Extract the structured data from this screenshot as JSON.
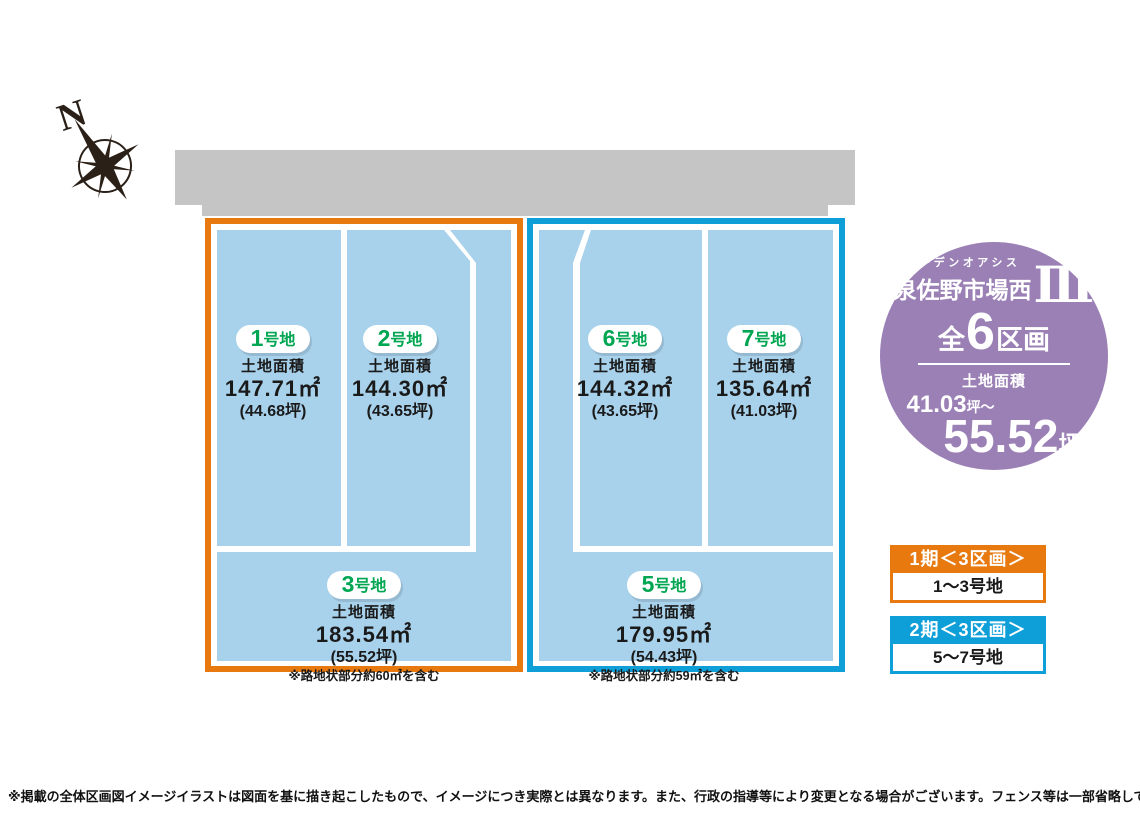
{
  "compass": {
    "label": "N"
  },
  "labels": {
    "area_label": "土地面積"
  },
  "plots": [
    {
      "num": "1",
      "suffix": "号地",
      "area": "147.71㎡",
      "tsubo": "(44.68坪)"
    },
    {
      "num": "2",
      "suffix": "号地",
      "area": "144.30㎡",
      "tsubo": "(43.65坪)"
    },
    {
      "num": "3",
      "suffix": "号地",
      "area": "183.54㎡",
      "tsubo": "(55.52坪)",
      "note": "※路地状部分約60㎡を含む"
    },
    {
      "num": "5",
      "suffix": "号地",
      "area": "179.95㎡",
      "tsubo": "(54.43坪)",
      "note": "※路地状部分約59㎡を含む"
    },
    {
      "num": "6",
      "suffix": "号地",
      "area": "144.32㎡",
      "tsubo": "(43.65坪)"
    },
    {
      "num": "7",
      "suffix": "号地",
      "area": "135.64㎡",
      "tsubo": "(41.03坪)"
    }
  ],
  "badge": {
    "subtitle": "ガーデンオアシス",
    "title": "泉佐野市場西",
    "numeral": "Ⅲ",
    "total_prefix": "全",
    "total_count": "6",
    "total_suffix": "区画",
    "area_label": "土地面積",
    "area_min": "41.03",
    "area_min_unit": "坪〜",
    "area_max": "55.52",
    "area_max_unit": "坪",
    "bg_color": "#9b80b5"
  },
  "legend": [
    {
      "phase": "1期＜3区画＞",
      "plots": "1〜3号地",
      "color": "#e8790e"
    },
    {
      "phase": "2期＜3区画＞",
      "plots": "5〜7号地",
      "color": "#0f9fd8"
    }
  ],
  "footer": {
    "disclaimer": "※掲載の全体区画図イメージイラストは図面を基に描き起こしたもので、イメージにつき実際とは異なります。また、行政の指導等により変更となる場合がございます。フェンス等は一部省略しております。"
  },
  "colors": {
    "road": "#c5c5c5",
    "plot_fill": "#a8d2ec",
    "phase1_accent": "#e8790e",
    "phase2_accent": "#0f9fd8",
    "pill_text": "#00a651",
    "badge_bg": "#9b80b5"
  }
}
